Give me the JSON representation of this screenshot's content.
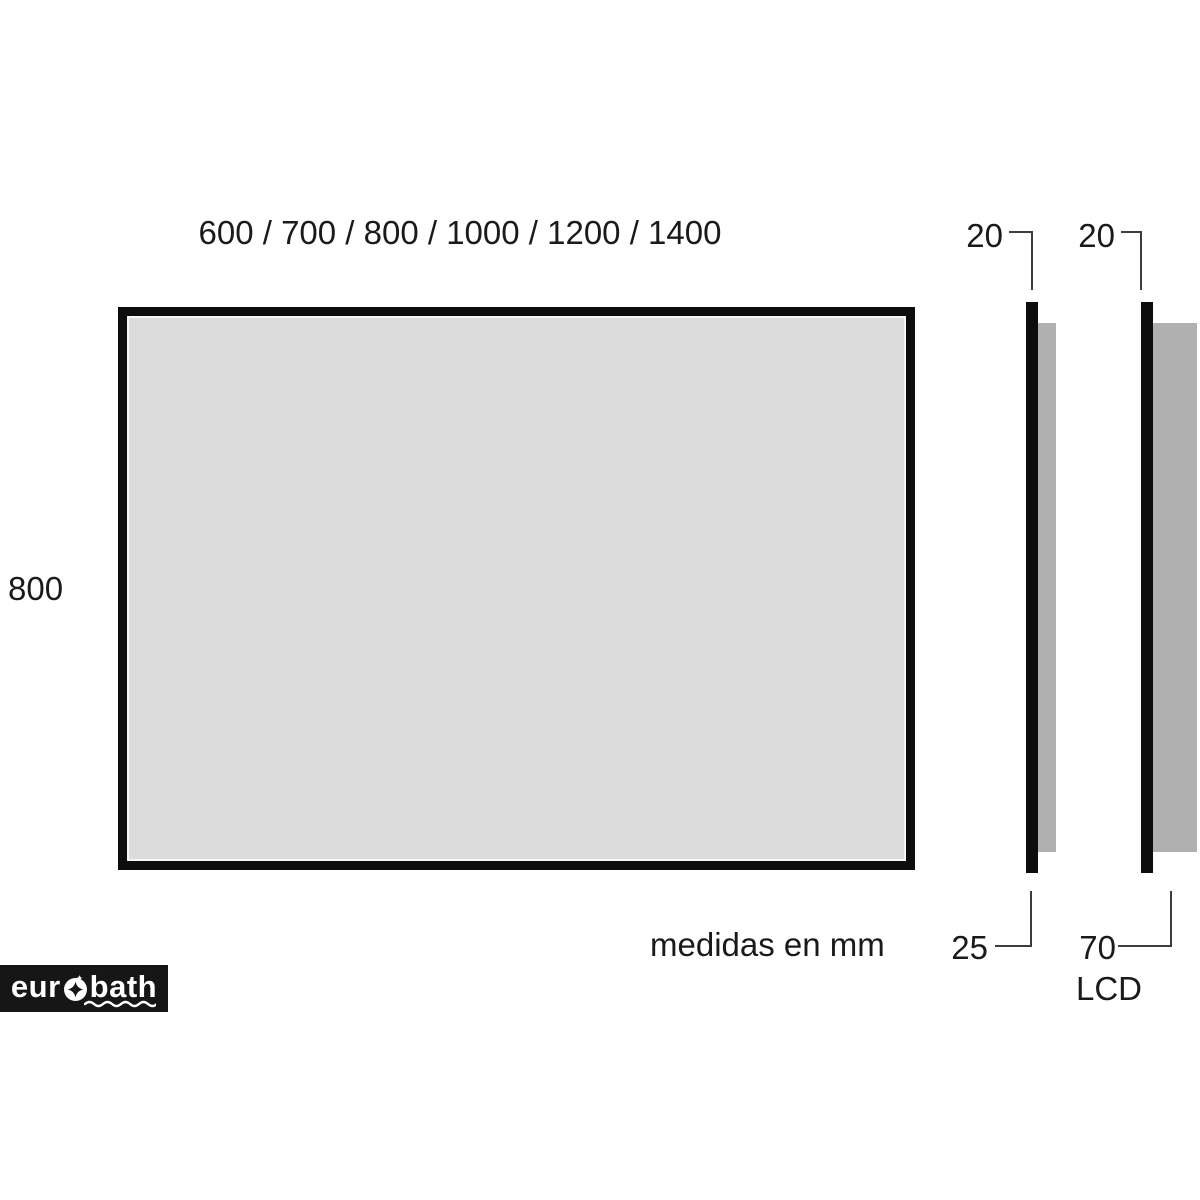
{
  "front_view": {
    "width_options_label": "600 / 700 / 800 / 1000 / 1200 / 1400",
    "height_label": "800"
  },
  "side_views": [
    {
      "glass_thickness_label": "20",
      "total_depth_label": "25"
    },
    {
      "glass_thickness_label": "20",
      "total_depth_label": "70",
      "screen_label": "LCD"
    }
  ],
  "footer": {
    "units_note": "medidas en mm"
  },
  "logo": {
    "brand_prefix": "eur",
    "brand_suffix": "bath"
  },
  "colors": {
    "mirror_fill": "#dcdcdc",
    "back_panel_gray": "#b0b0b0",
    "frame_black": "#0d0d0d",
    "leader_line": "#3d3d3d",
    "logo_background": "#161616",
    "logo_foreground": "#ffffff"
  }
}
